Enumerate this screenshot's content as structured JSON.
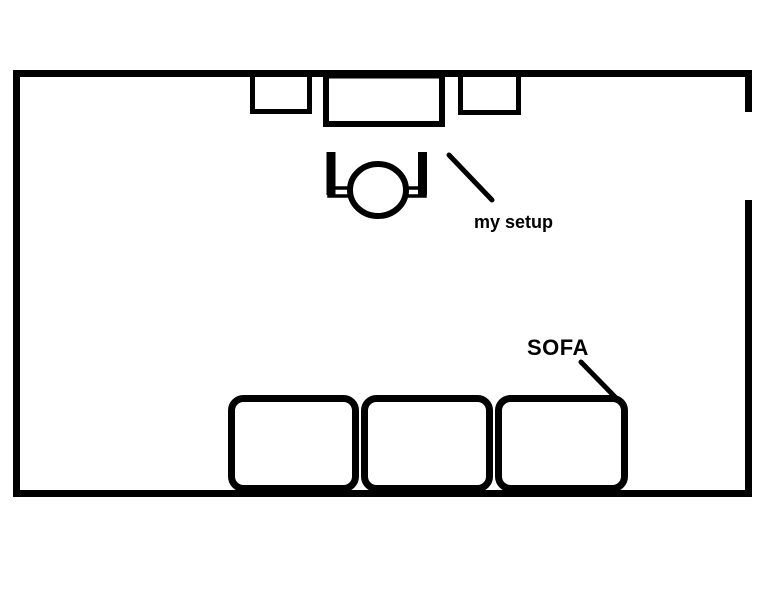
{
  "colors": {
    "ink": "#000000",
    "background": "#ffffff"
  },
  "annotations": {
    "setup_label": "my setup",
    "sofa_label": "SOFA"
  }
}
